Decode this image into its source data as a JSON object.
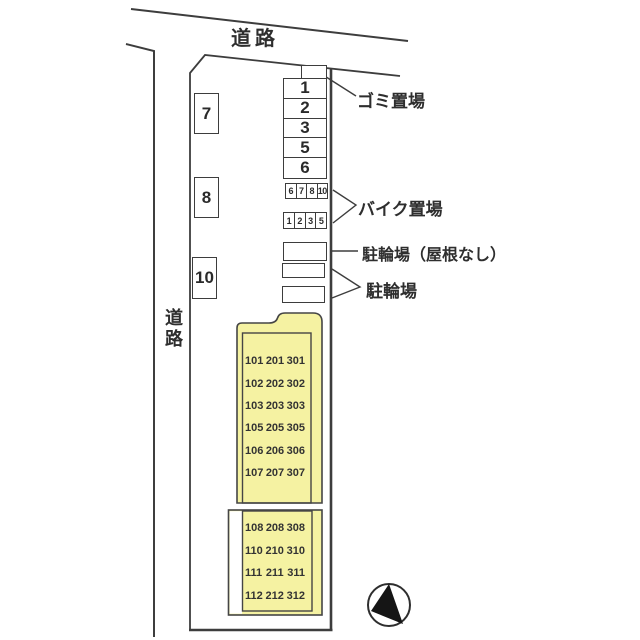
{
  "colors": {
    "building_fill": "#f5f2a2",
    "line": "#3d3d3d",
    "text": "#2e2e2e"
  },
  "roads": {
    "top_label": "道路",
    "left_label": "道路"
  },
  "site": {
    "parking_left": [
      "7",
      "8",
      "10"
    ],
    "parking_right": [
      "1",
      "2",
      "3",
      "5",
      "6"
    ],
    "garbage": {
      "label": "ゴミ置場"
    },
    "bike": {
      "label": "バイク置場",
      "row_top": [
        "6",
        "7",
        "8",
        "10"
      ],
      "row_bottom": [
        "1",
        "2",
        "3",
        "5"
      ]
    },
    "bicycle_no_roof": {
      "label": "駐輪場（屋根なし）"
    },
    "bicycle": {
      "label": "駐輪場"
    },
    "building": {
      "upper_rows": [
        [
          "101",
          "201",
          "301"
        ],
        [
          "102",
          "202",
          "302"
        ],
        [
          "103",
          "203",
          "303"
        ],
        [
          "105",
          "205",
          "305"
        ],
        [
          "106",
          "206",
          "306"
        ],
        [
          "107",
          "207",
          "307"
        ]
      ],
      "lower_rows": [
        [
          "108",
          "208",
          "308"
        ],
        [
          "110",
          "210",
          "310"
        ],
        [
          "111",
          "211",
          "311"
        ],
        [
          "112",
          "212",
          "312"
        ]
      ]
    },
    "icons": {
      "compass": "north-arrow-icon"
    }
  }
}
